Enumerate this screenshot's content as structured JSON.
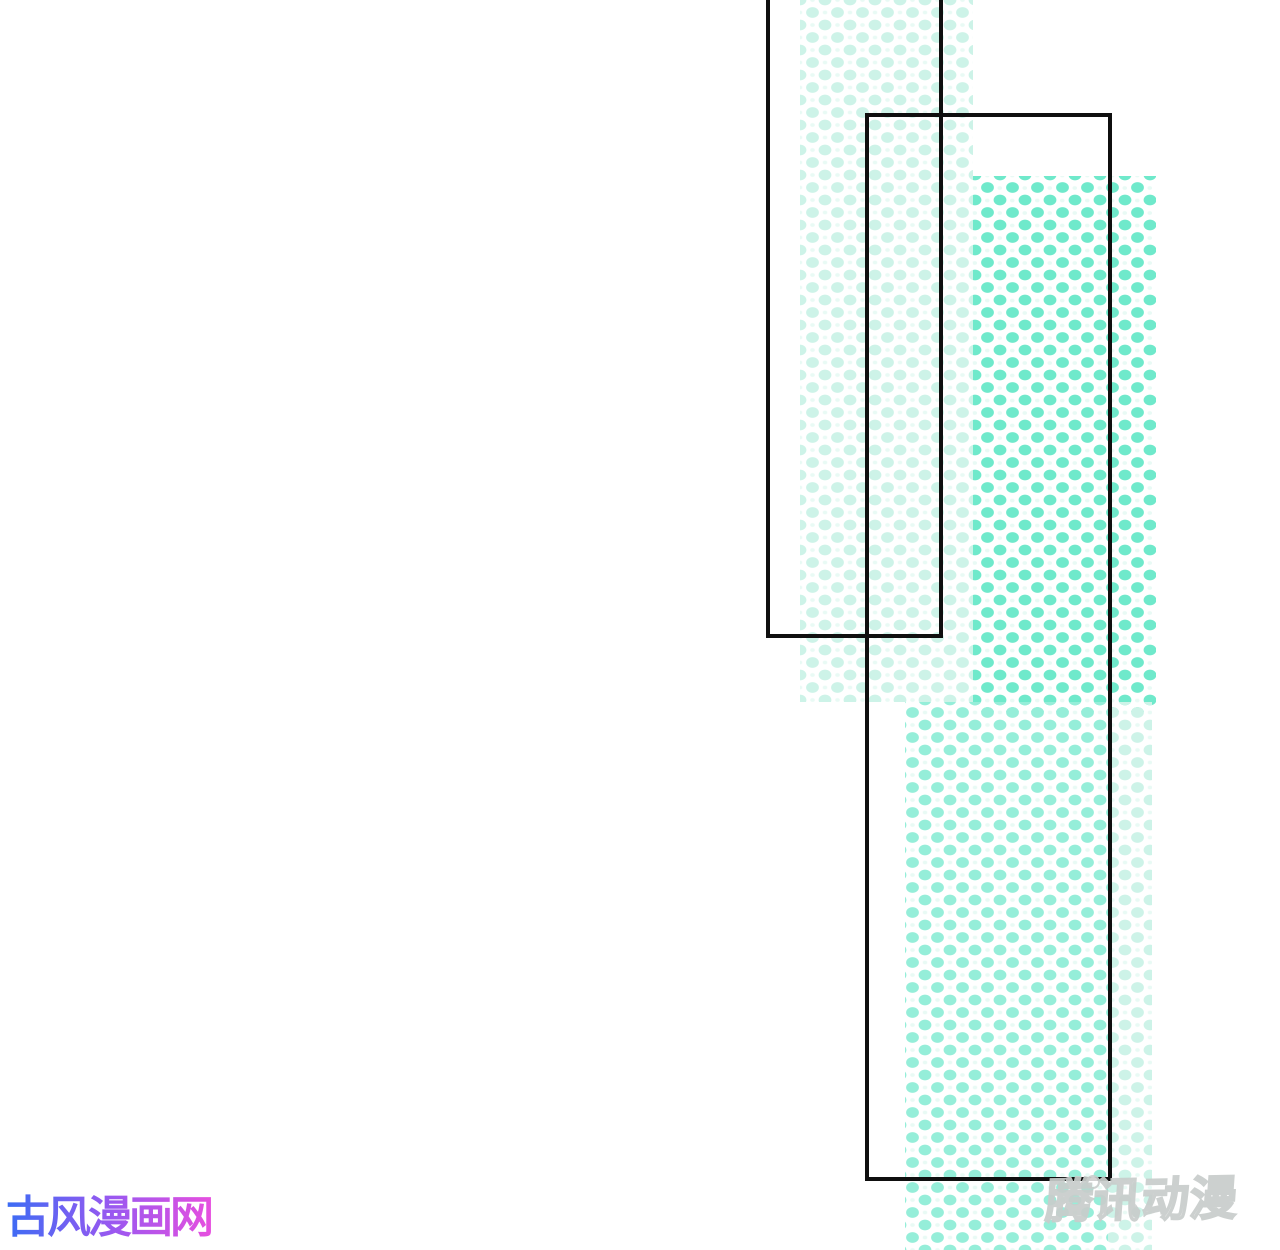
{
  "page": {
    "background": "#ffffff",
    "description": "manga page with halftone panels"
  },
  "theme": {
    "halftone_strong": "#6fe9cb",
    "halftone_medium": "#95eed9",
    "halftone_light": "#cdf3e8",
    "halftone_faint": "#e9faf5",
    "panel_border": "#0f0f0f",
    "logo_grad_start": "#3b6cf4",
    "logo_grad_mid": "#9a58f0",
    "logo_grad_end": "#e64fdf",
    "tencent_fill": "#ffffff",
    "tencent_outline": "#c8cdcb"
  },
  "watermarks": {
    "site_logo": {
      "text": "古风漫画网"
    },
    "platform_logo": {
      "text": "腾讯动漫"
    }
  }
}
